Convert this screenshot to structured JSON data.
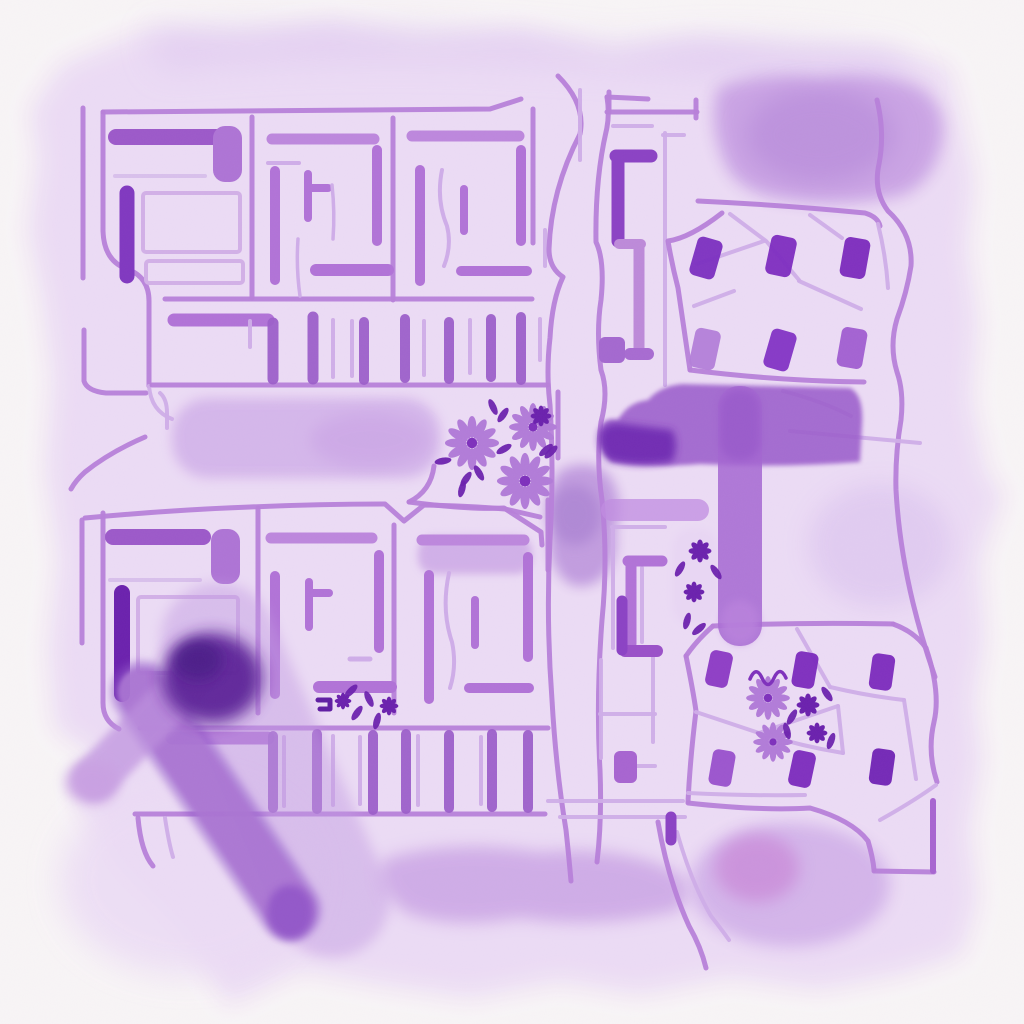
{
  "palette": {
    "paper": "#f8f5f6",
    "wash_base": "#ecdcf5",
    "wash_light": "#e0cbf1",
    "wash_mid": "#d3b3ea",
    "wash_deep": "#c9a2e4",
    "pink": "#ca8cd9",
    "line_light": "#cfade8",
    "line_mid": "#b77fd9",
    "line_strong": "#a765d0",
    "bar_mid": "#b173d7",
    "bar_dark": "#8b42c4",
    "accent_dark": "#7e30bc",
    "accent_deep": "#6b21ad",
    "deepest": "#54188f",
    "t_road": "#9d60cc",
    "t_lobe": "#6f2cb2",
    "t_bar": "#a566d1",
    "stroke_band": "#ab76d3",
    "stroke_swath": "#c29ae2",
    "stroke_core": "#5b2497",
    "flower_petal": "#b27cd8",
    "flower_center": "#7e30bc"
  },
  "buildings": {
    "top_right": {
      "w": 26,
      "h": 40,
      "items": [
        {
          "x": 706,
          "y": 258,
          "r": 16,
          "f": "#7b2fc0"
        },
        {
          "x": 781,
          "y": 256,
          "r": 12,
          "f": "#7e2dbf"
        },
        {
          "x": 855,
          "y": 258,
          "r": 10,
          "f": "#7b2abc"
        },
        {
          "x": 705,
          "y": 349,
          "r": 12,
          "f": "#b37fd9"
        },
        {
          "x": 780,
          "y": 350,
          "r": 16,
          "f": "#8233c5"
        },
        {
          "x": 852,
          "y": 348,
          "r": 10,
          "f": "#a05ed0"
        }
      ]
    },
    "bottom_right": {
      "w": 23,
      "h": 36,
      "items": [
        {
          "x": 719,
          "y": 669,
          "r": 12,
          "f": "#8a38c4"
        },
        {
          "x": 805,
          "y": 670,
          "r": 10,
          "f": "#7b2abc"
        },
        {
          "x": 882,
          "y": 672,
          "r": 8,
          "f": "#7b2abc"
        },
        {
          "x": 722,
          "y": 768,
          "r": 10,
          "f": "#9850cc"
        },
        {
          "x": 802,
          "y": 769,
          "r": 12,
          "f": "#7b2abc"
        },
        {
          "x": 882,
          "y": 767,
          "r": 8,
          "f": "#6f22b4"
        }
      ]
    }
  },
  "ticks": {
    "top": [
      {
        "x": 250,
        "y1": 321,
        "y2": 347,
        "w": 4
      },
      {
        "x": 273,
        "y1": 323,
        "y2": 379,
        "w": 11
      },
      {
        "x": 313,
        "y1": 317,
        "y2": 379,
        "w": 11
      },
      {
        "x": 333,
        "y1": 320,
        "y2": 377,
        "w": 4
      },
      {
        "x": 352,
        "y1": 321,
        "y2": 376,
        "w": 4
      },
      {
        "x": 364,
        "y1": 322,
        "y2": 380,
        "w": 10
      },
      {
        "x": 405,
        "y1": 319,
        "y2": 378,
        "w": 10
      },
      {
        "x": 424,
        "y1": 321,
        "y2": 375,
        "w": 4
      },
      {
        "x": 449,
        "y1": 322,
        "y2": 379,
        "w": 10
      },
      {
        "x": 470,
        "y1": 320,
        "y2": 373,
        "w": 4
      },
      {
        "x": 491,
        "y1": 319,
        "y2": 377,
        "w": 10
      },
      {
        "x": 521,
        "y1": 317,
        "y2": 380,
        "w": 10
      },
      {
        "x": 540,
        "y1": 319,
        "y2": 360,
        "w": 4
      }
    ],
    "bottom": [
      {
        "x": 273,
        "y1": 736,
        "y2": 808,
        "w": 10
      },
      {
        "x": 284,
        "y1": 737,
        "y2": 806,
        "w": 4
      },
      {
        "x": 317,
        "y1": 734,
        "y2": 809,
        "w": 10
      },
      {
        "x": 333,
        "y1": 736,
        "y2": 805,
        "w": 4
      },
      {
        "x": 360,
        "y1": 737,
        "y2": 804,
        "w": 4
      },
      {
        "x": 373,
        "y1": 735,
        "y2": 810,
        "w": 10
      },
      {
        "x": 406,
        "y1": 734,
        "y2": 809,
        "w": 10
      },
      {
        "x": 418,
        "y1": 736,
        "y2": 805,
        "w": 4
      },
      {
        "x": 449,
        "y1": 735,
        "y2": 808,
        "w": 10
      },
      {
        "x": 481,
        "y1": 737,
        "y2": 804,
        "w": 4
      },
      {
        "x": 492,
        "y1": 734,
        "y2": 807,
        "w": 10
      },
      {
        "x": 528,
        "y1": 735,
        "y2": 808,
        "w": 10
      }
    ]
  },
  "flowers": {
    "outline": [
      {
        "x": 472,
        "y": 443,
        "r": 26
      },
      {
        "x": 533,
        "y": 427,
        "r": 23
      },
      {
        "x": 525,
        "y": 481,
        "r": 27
      },
      {
        "x": 768,
        "y": 698,
        "r": 21
      },
      {
        "x": 773,
        "y": 742,
        "r": 19
      }
    ],
    "solid": [
      {
        "x": 700,
        "y": 551,
        "r": 11
      },
      {
        "x": 694,
        "y": 592,
        "r": 10
      },
      {
        "x": 343,
        "y": 701,
        "r": 8
      },
      {
        "x": 389,
        "y": 706,
        "r": 9
      },
      {
        "x": 808,
        "y": 705,
        "r": 11
      },
      {
        "x": 817,
        "y": 733,
        "r": 10
      },
      {
        "x": 541,
        "y": 416,
        "r": 10
      }
    ],
    "leaves": [
      {
        "x": 493,
        "y": 407,
        "a": -25
      },
      {
        "x": 503,
        "y": 415,
        "a": 35
      },
      {
        "x": 551,
        "y": 452,
        "a": 45
      },
      {
        "x": 466,
        "y": 479,
        "a": 35
      },
      {
        "x": 479,
        "y": 473,
        "a": -30
      },
      {
        "x": 443,
        "y": 461,
        "a": 80
      },
      {
        "x": 462,
        "y": 489,
        "a": 15
      },
      {
        "x": 504,
        "y": 449,
        "a": 60
      },
      {
        "x": 546,
        "y": 450,
        "a": 50
      },
      {
        "x": 680,
        "y": 569,
        "a": 30
      },
      {
        "x": 716,
        "y": 572,
        "a": -35
      },
      {
        "x": 687,
        "y": 621,
        "a": 15
      },
      {
        "x": 699,
        "y": 629,
        "a": 50
      },
      {
        "x": 357,
        "y": 713,
        "a": 35
      },
      {
        "x": 369,
        "y": 699,
        "a": -25
      },
      {
        "x": 377,
        "y": 721,
        "a": 15
      },
      {
        "x": 351,
        "y": 691,
        "a": 45
      },
      {
        "x": 827,
        "y": 694,
        "a": -35
      },
      {
        "x": 792,
        "y": 717,
        "a": 30
      },
      {
        "x": 831,
        "y": 741,
        "a": 20
      },
      {
        "x": 787,
        "y": 731,
        "a": -15
      }
    ]
  }
}
